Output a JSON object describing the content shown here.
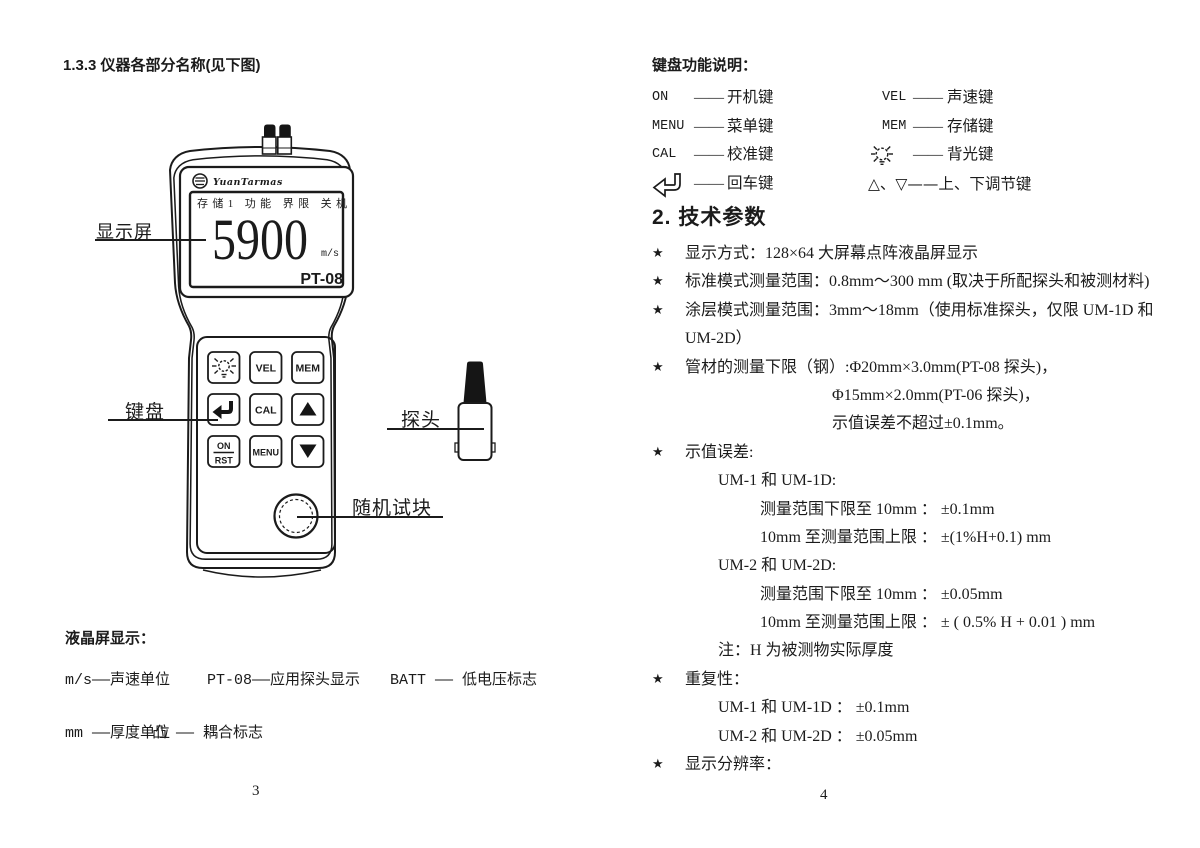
{
  "left_page": {
    "title": "1.3.3  仪器各部分名称(见下图)",
    "device": {
      "brand": "YuanTarmas",
      "lcd_menu": "存储1 功能 界限 关机",
      "lcd_value": "5900",
      "lcd_unit": "m/s",
      "lcd_model": "PT-08",
      "keys": {
        "vel": "VEL",
        "mem": "MEM",
        "cal": "CAL",
        "menu": "MENU",
        "on": "ON",
        "rst": "RST"
      }
    },
    "callouts": {
      "display": "显示屏",
      "keypad": "键盘",
      "probe": "探头",
      "test_block": "随机试块"
    },
    "legend": {
      "heading": "液晶屏显示：",
      "row1_col1": "m/s——声速单位",
      "row1_col2": "PT-08——应用探头显示",
      "row1_col3": "BATT —— 低电压标志",
      "row2_col1": "mm ——厚度单位",
      "row2_col2": "凸 ——  耦合标志"
    },
    "page_number": "3"
  },
  "right_page": {
    "keys_heading": "键盘功能说明：",
    "dash": "——",
    "key_rows": [
      {
        "lk": "ON",
        "lt": "开机键",
        "rk": "VEL",
        "rt": "声速键"
      },
      {
        "lk": "MENU",
        "lt": "菜单键",
        "rk": "MEM",
        "rt": "存储键"
      },
      {
        "lk": "CAL",
        "lt": "校准键",
        "rt": "背光键"
      },
      {
        "lt": "回车键",
        "rt": "△、▽——上、下调节键"
      }
    ],
    "tech_title": "2. 技术参数",
    "star": "★",
    "specs": [
      {
        "text": "显示方式：128×64 大屏幕点阵液晶屏显示"
      },
      {
        "text": "标准模式测量范围：0.8mm～300 mm (取决于所配探头和被测材料)"
      },
      {
        "text": "涂层模式测量范围：3mm～18mm（使用标准探头，仅限 UM-1D 和"
      },
      {
        "text": "UM-2D）"
      },
      {
        "text": "管材的测量下限（钢）:Φ20mm×3.0mm(PT-08 探头)，"
      },
      {
        "text": "Φ15mm×2.0mm(PT-06 探头)，"
      },
      {
        "text": "示值误差不超过±0.1mm。"
      },
      {
        "text": "示值误差:"
      },
      {
        "text": "UM-1 和 UM-1D:"
      },
      {
        "text": "测量范围下限至 10mm ： ±0.1mm"
      },
      {
        "text": "10mm 至测量范围上限 ： ±(1%H+0.1) mm"
      },
      {
        "text": "UM-2 和 UM-2D:"
      },
      {
        "text": "测量范围下限至 10mm ： ±0.05mm"
      },
      {
        "text": "10mm 至测量范围上限 ： ± ( 0.5% H + 0.01 ) mm"
      },
      {
        "text": "注：H 为被测物实际厚度"
      },
      {
        "text": "重复性："
      },
      {
        "text": "UM-1 和 UM-1D ： ±0.1mm"
      },
      {
        "text": "UM-2 和 UM-2D ： ±0.05mm"
      },
      {
        "text": "显示分辨率："
      }
    ],
    "page_number": "4"
  }
}
